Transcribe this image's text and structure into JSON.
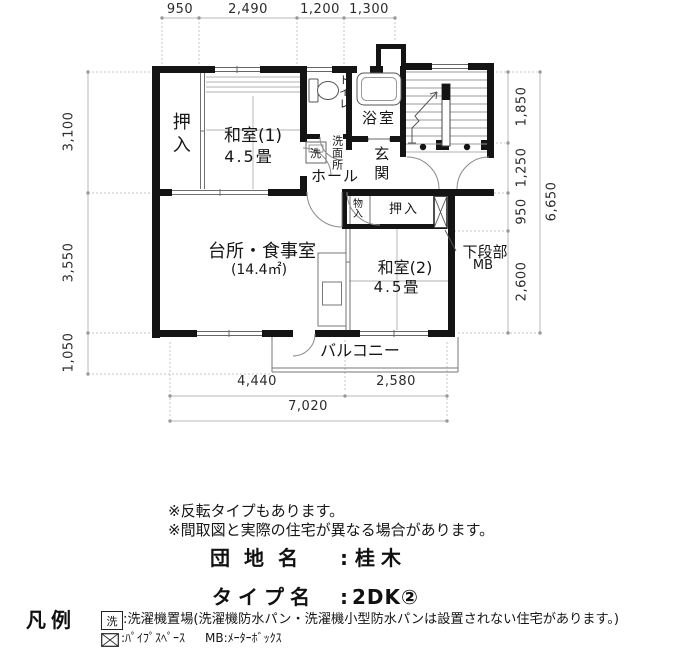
{
  "plan": {
    "dims": {
      "top": [
        "950",
        "2,490",
        "1,200",
        "1,300"
      ],
      "left": [
        "3,100",
        "3,550",
        "1,050"
      ],
      "right": [
        "1,850",
        "1,250",
        "950",
        "2,600"
      ],
      "right_total": "6,650",
      "bottom": [
        "4,440",
        "2,580"
      ],
      "bottom_total": "7,020"
    },
    "rooms": {
      "closet1": "押入",
      "japanese_room1": "和室(1)",
      "japanese_room1_size": "4.5畳",
      "toilet": "トイレ",
      "washroom": "洗面所",
      "laundry_symbol": "洗",
      "bathroom": "浴室",
      "entrance": "玄関",
      "hall": "ホール",
      "kitchen": "台所・食事室",
      "kitchen_area": "(14.4㎡)",
      "storage": "物入",
      "closet2": "押入",
      "lower_section": "下段部",
      "meter_box": "MB",
      "japanese_room2": "和室(2)",
      "japanese_room2_size": "4.5畳",
      "balcony": "バルコニー"
    }
  },
  "notes": {
    "line1": "※反転タイプもあります。",
    "line2": "※間取図と実際の住宅が異なる場合があります。"
  },
  "estate": {
    "name_label": "団地名",
    "name_colon": ":",
    "name_value": "桂木",
    "type_label": "タイプ名",
    "type_colon": ":",
    "type_value": "2DK②"
  },
  "legend": {
    "title": "凡例",
    "laundry_symbol": "洗",
    "laundry_text": ":洗濯機置場(洗濯機防水パン・洗濯機小型防水パンは設置されない住宅があります。)",
    "pipe_space_text": ":ﾊﾟｲﾌﾟｽﾍﾟｰｽ",
    "meter_box_text": "MB:ﾒｰﾀｰﾎﾞｯｸｽ"
  }
}
